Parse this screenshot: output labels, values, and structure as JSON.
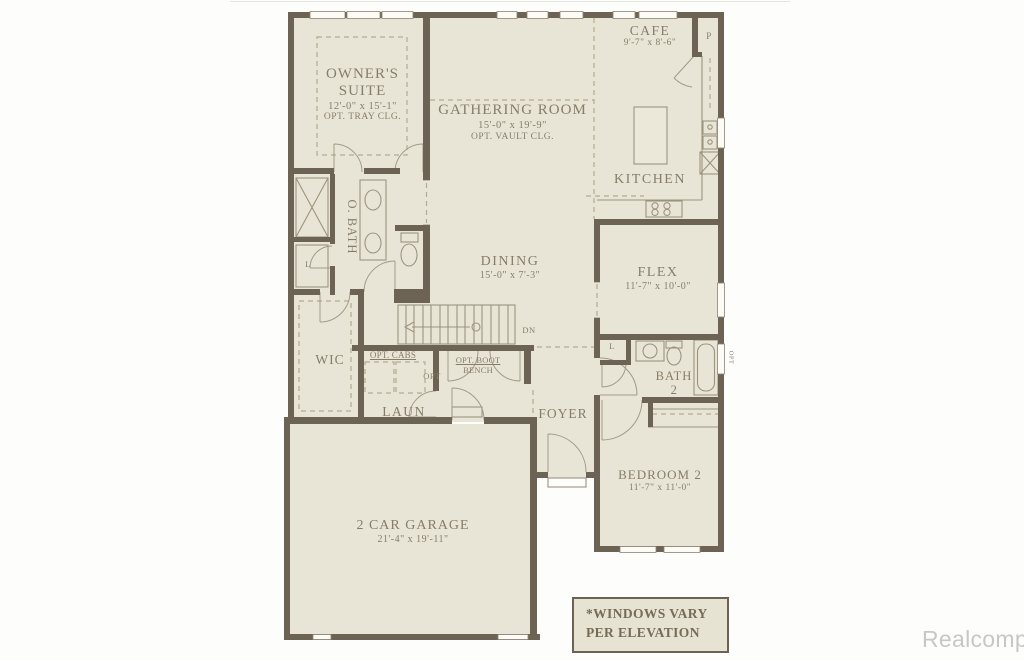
{
  "rooms": {
    "owners_suite": {
      "line1": "OWNER'S",
      "line2": "SUITE",
      "size": "12'-0\" x 15'-1\"",
      "note": "OPT. TRAY CLG."
    },
    "gathering_room": {
      "name": "GATHERING ROOM",
      "size": "15'-0\" x 19'-9\"",
      "note": "OPT. VAULT CLG."
    },
    "cafe": {
      "name": "CAFE",
      "size": "9'-7\" x 8'-6\""
    },
    "kitchen": {
      "name": "KITCHEN"
    },
    "owners_bath": {
      "name": "O. BATH"
    },
    "dining": {
      "name": "DINING",
      "size": "15'-0\" x 7'-3\""
    },
    "flex": {
      "name": "FLEX",
      "size": "11'-7\" x 10'-0\""
    },
    "wic": {
      "name": "WIC"
    },
    "laundry": {
      "name": "LAUN"
    },
    "foyer": {
      "name": "FOYER"
    },
    "bath2": {
      "line1": "BATH",
      "line2": "2"
    },
    "bedroom2": {
      "name": "BEDROOM 2",
      "size": "11'-7\" x 11'-0\""
    },
    "garage": {
      "name": "2 CAR GARAGE",
      "size": "21'-4\" x 19'-11\""
    }
  },
  "annotations": {
    "opt_cabs": "OPT. CABS",
    "opt": "OPT",
    "boot_line1": "OPT. BOOT",
    "boot_line2": "BENCH",
    "down": "DN",
    "pantry": "P",
    "linen_obath": "L",
    "linen_bath2": "L",
    "opt_window": "OPT"
  },
  "note_box": {
    "line1": "*WINDOWS VARY",
    "line2": "PER ELEVATION"
  },
  "watermark": "Realcomp",
  "colors": {
    "wall": "#6c6355",
    "floor": "#e9e5d6",
    "text": "#867d69",
    "thin_line": "#9c937f",
    "dashed_line": "#b3aa92",
    "watermark_text": "#c7c7c7"
  }
}
